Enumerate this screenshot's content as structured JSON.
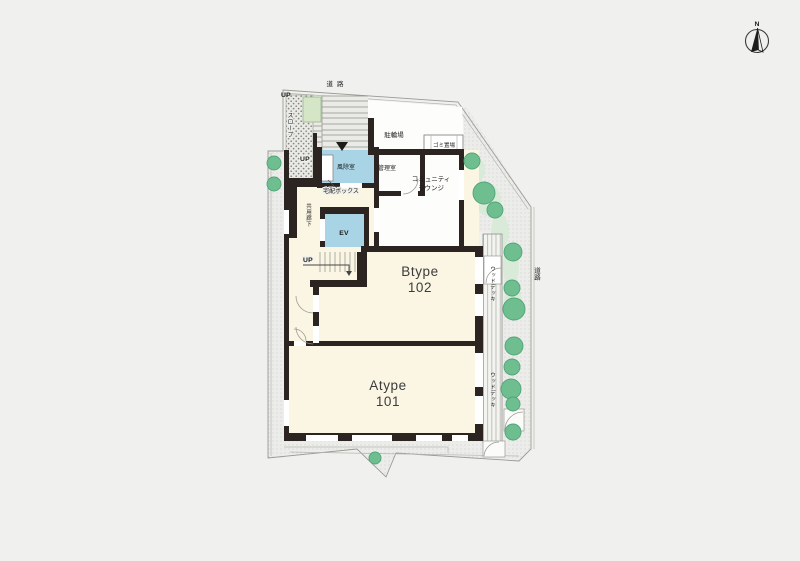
{
  "plan": {
    "title": "site-floor-plan",
    "compass": {
      "north_label": "N"
    },
    "roads": {
      "top": "道路",
      "right": "道路"
    },
    "site": {
      "slope_label": "スロープ",
      "up_slope_top": "UP",
      "up_slope_mid": "UP",
      "up_stair_interior": "UP",
      "bicycle_parking": "駐輪場",
      "garbage_area": "ゴミ置場",
      "windbreak_room": "風除室",
      "manager_room": "管理室",
      "delivery_box": "宅配ボックス",
      "community_lounge_line1": "コミュニティ",
      "community_lounge_line2": "ラウンジ",
      "common_corridor": "共用廊下",
      "elevator": "EV",
      "wood_deck_upper": "ウッドデッキ",
      "wood_deck_lower": "ウッドデッキ"
    },
    "units": [
      {
        "type_label": "Btype",
        "number": "102"
      },
      {
        "type_label": "Atype",
        "number": "101"
      }
    ],
    "colors": {
      "cream": "#FAF6E3",
      "room_blue": "#A8D4E6",
      "tree_green": "#6FBE90",
      "planter_green": "#D4E6C6",
      "wall": "#2B2420"
    }
  }
}
